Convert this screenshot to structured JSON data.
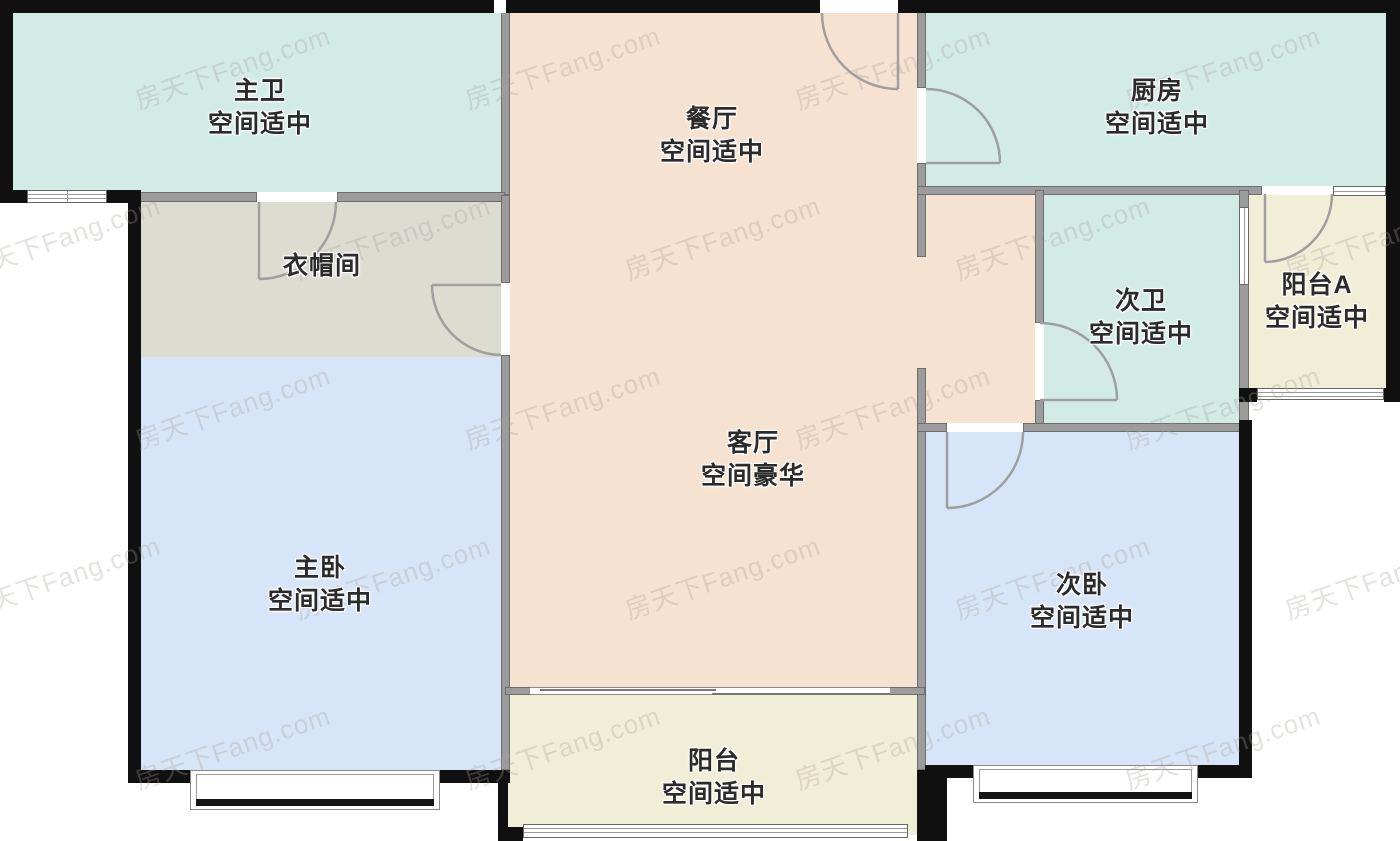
{
  "plan": {
    "watermark_text": "房天下Fang.com",
    "colors": {
      "bath_kitchen": "#d2ebe5",
      "living_dining": "#f6e2d0",
      "closet": "#dcdcd1",
      "bedroom": "#d7e5f8",
      "balcony": "#f0eed7",
      "wall": "#9c9c9c",
      "outer_wall": "#101010"
    },
    "rooms": [
      {
        "id": "master-bath",
        "name": "主卫",
        "desc": "空间适中"
      },
      {
        "id": "dining",
        "name": "餐厅",
        "desc": "空间适中"
      },
      {
        "id": "kitchen",
        "name": "厨房",
        "desc": "空间适中"
      },
      {
        "id": "closet",
        "name": "衣帽间",
        "desc": ""
      },
      {
        "id": "second-bath",
        "name": "次卫",
        "desc": "空间适中"
      },
      {
        "id": "balcony-a",
        "name": "阳台A",
        "desc": "空间适中"
      },
      {
        "id": "living",
        "name": "客厅",
        "desc": "空间豪华"
      },
      {
        "id": "master-bed",
        "name": "主卧",
        "desc": "空间适中"
      },
      {
        "id": "second-bed",
        "name": "次卧",
        "desc": "空间适中"
      },
      {
        "id": "balcony",
        "name": "阳台",
        "desc": "空间适中"
      }
    ]
  }
}
